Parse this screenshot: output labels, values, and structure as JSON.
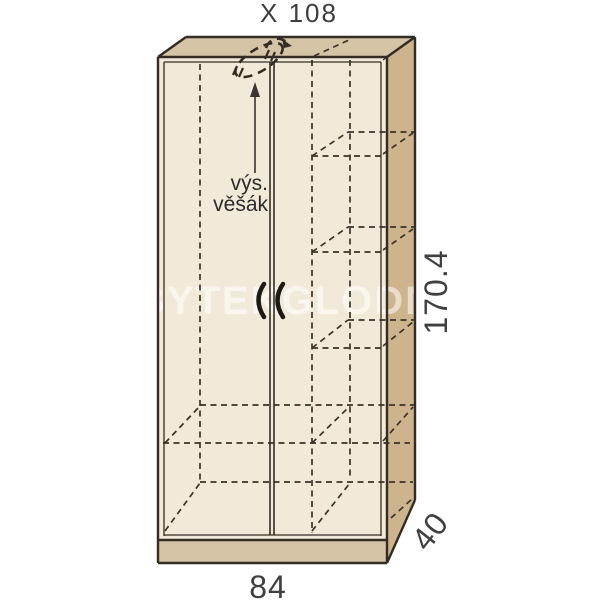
{
  "title": "X 108",
  "hanger_label": {
    "line1": "výs.",
    "line2": "věšák"
  },
  "dimensions": {
    "height": "170.4",
    "width": "84",
    "depth": "40"
  },
  "watermark": "BYTEKGLODN",
  "colors": {
    "background": "#ffffff",
    "front_face": "#f2ead9",
    "top_face": "#d6c4a6",
    "side_face": "#cdb48d",
    "plinth": "#d6c4a6",
    "outline": "#332c24",
    "hidden_line": "#3a3329",
    "dimension_text": "#3f3f3f"
  }
}
